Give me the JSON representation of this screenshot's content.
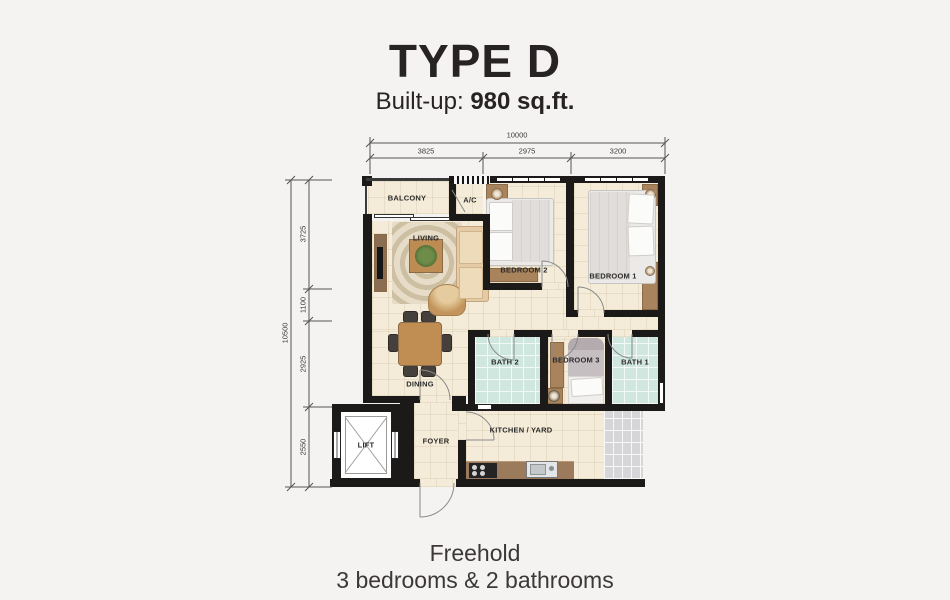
{
  "header": {
    "title": "TYPE D",
    "builtup_label": "Built-up:",
    "builtup_value": "980 sq.ft."
  },
  "footer": {
    "tenure": "Freehold",
    "configuration": "3 bedrooms & 2 bathrooms"
  },
  "dimensions": {
    "top_total": "10000",
    "top_segments": [
      "3825",
      "2975",
      "3200"
    ],
    "left_total": "10500",
    "left_segments": [
      "3725",
      "1100",
      "2925",
      "2550"
    ]
  },
  "rooms": {
    "balcony": "BALCONY",
    "ac": "A/C",
    "living": "LIVING",
    "bedroom2": "BEDROOM 2",
    "bedroom1": "BEDROOM 1",
    "bath2": "BATH 2",
    "bedroom3": "BEDROOM 3",
    "bath1": "BATH 1",
    "dining": "DINING",
    "lift": "LIFT",
    "foyer": "FOYER",
    "kitchen_yard": "KITCHEN / YARD"
  },
  "colors": {
    "background": "#f4f3f1",
    "wall": "#1c1a19",
    "floor_tile": "#f4ecd9",
    "bath_tile": "#cfe7df",
    "yard_tile": "#d6d6d8",
    "wood": "#a9835b",
    "text": "#272324"
  }
}
